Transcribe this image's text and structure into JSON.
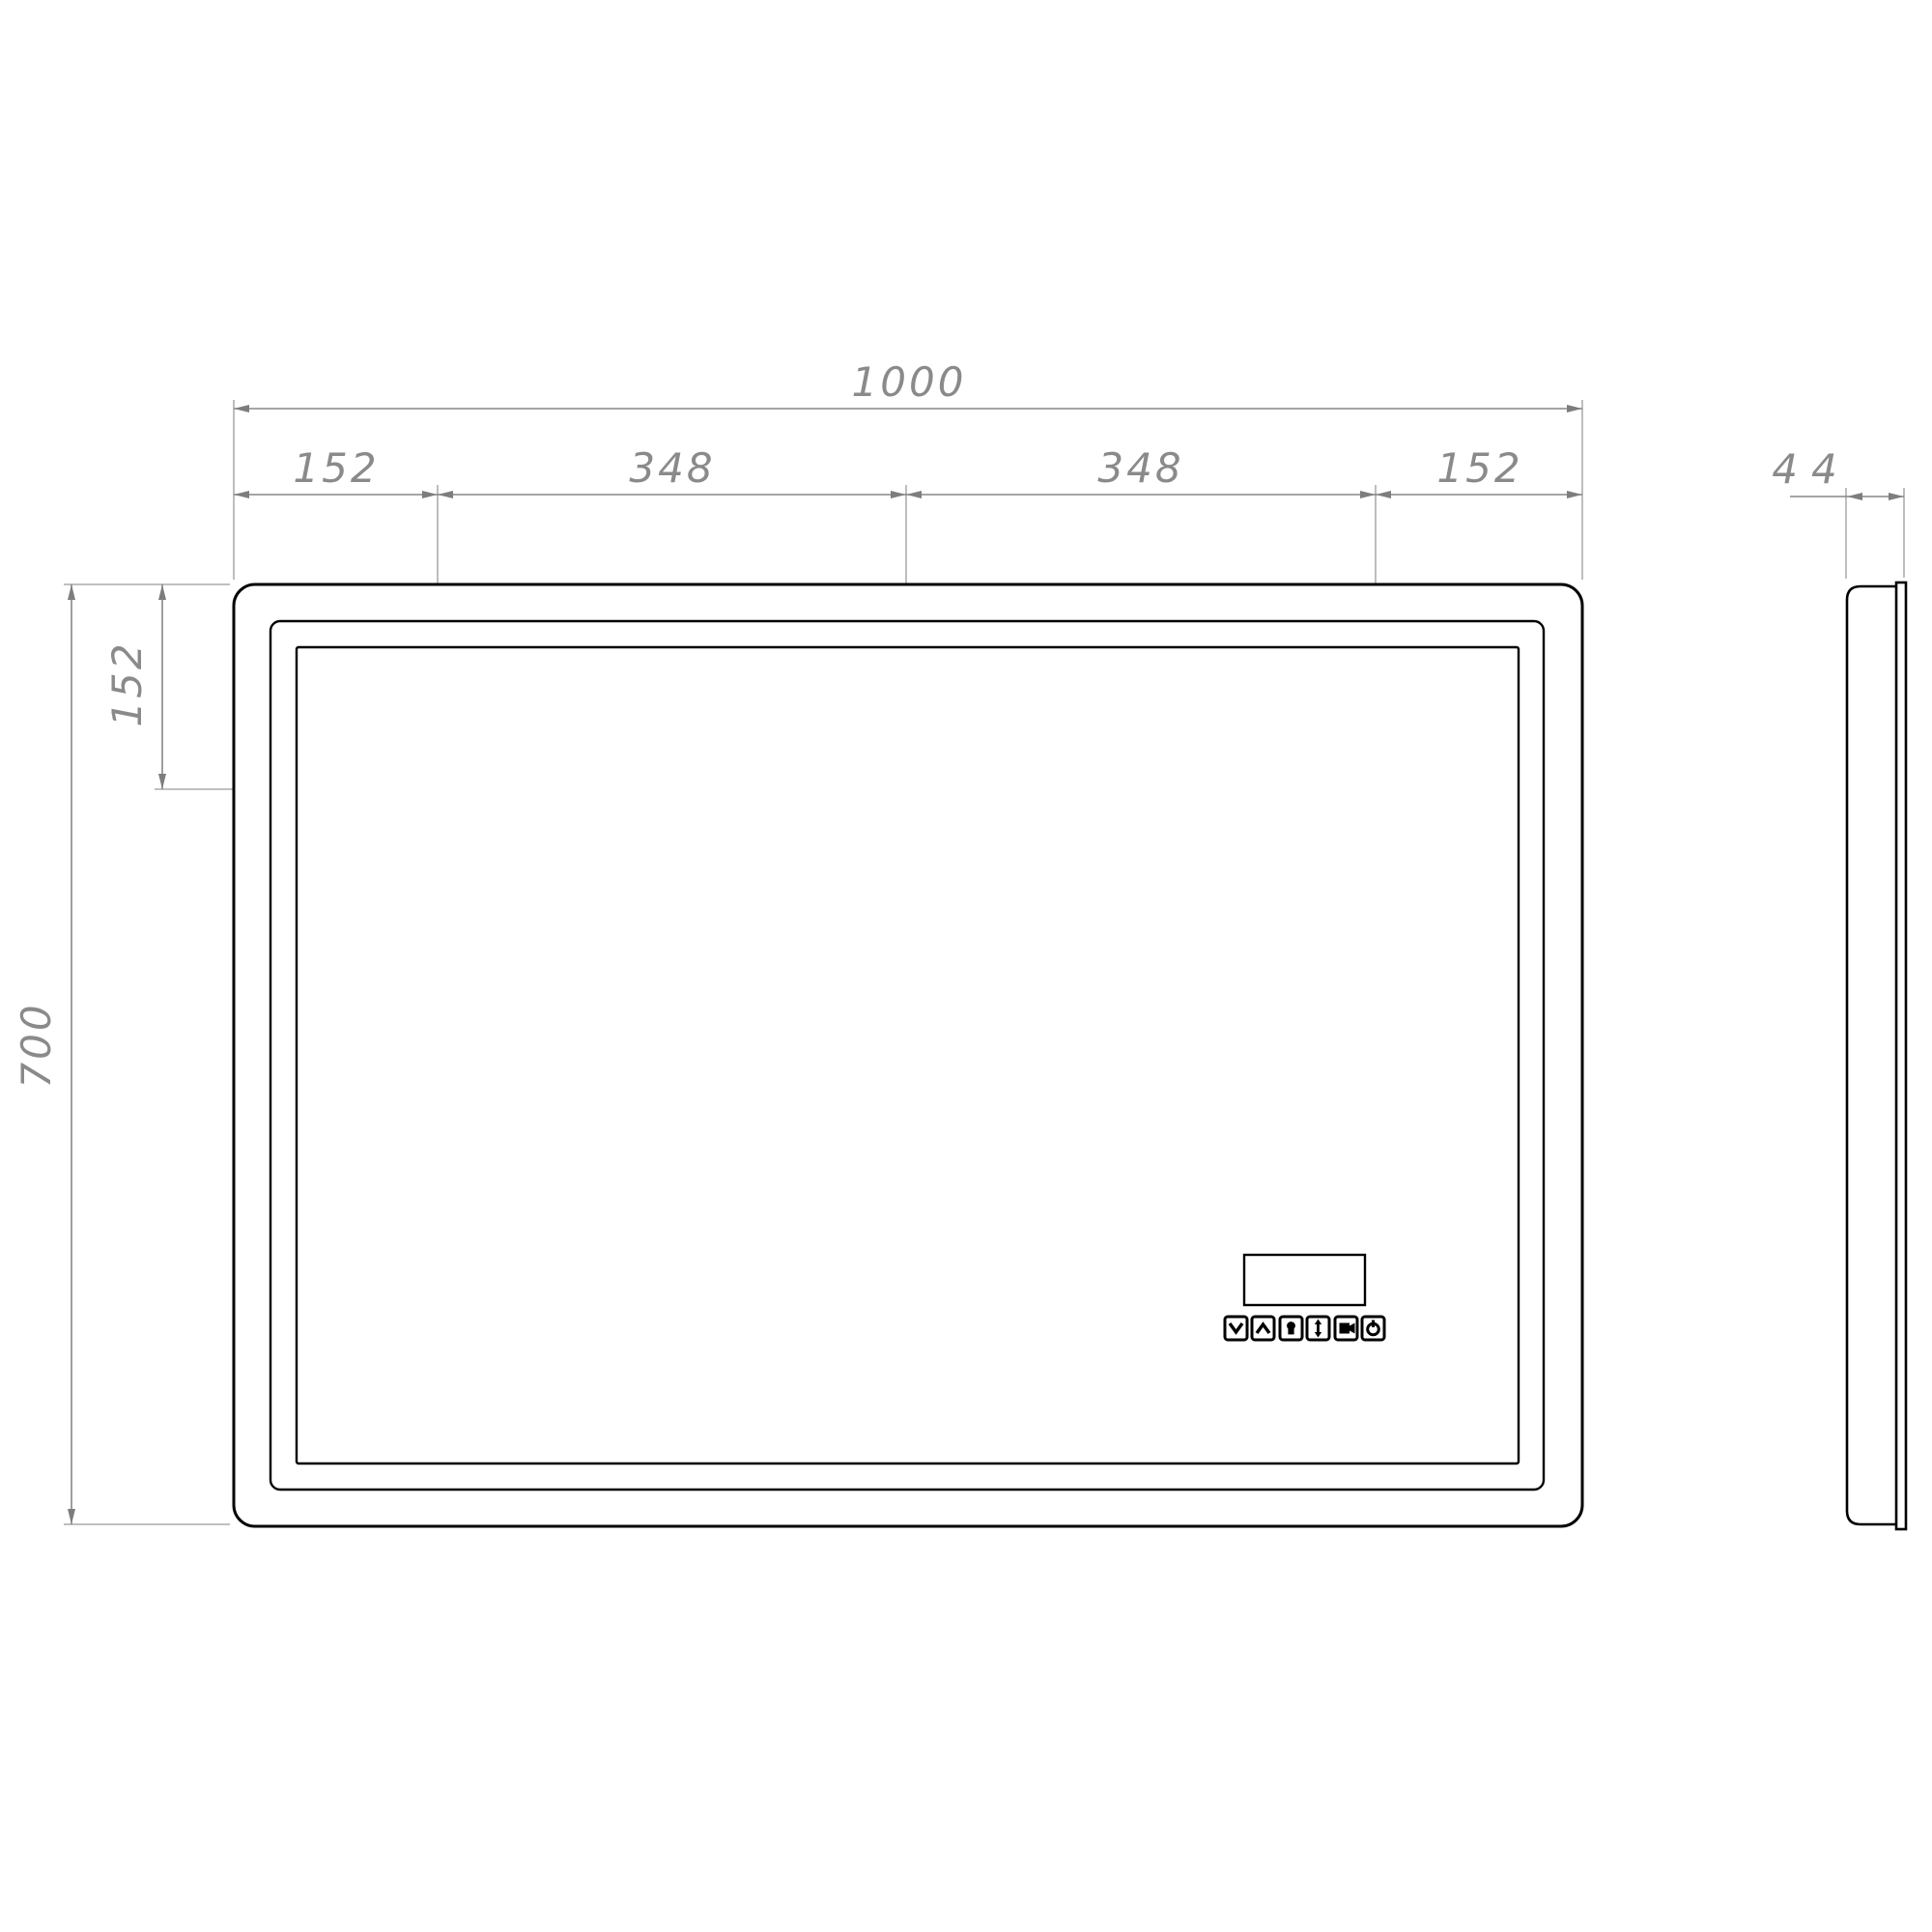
{
  "dimensions": {
    "total_width": "1000",
    "width_segments": [
      "152",
      "348",
      "348",
      "152"
    ],
    "height": "700",
    "mount_top_offset": "152",
    "depth": "44"
  },
  "mount_points": [
    {
      "label": "A"
    },
    {
      "label": "B"
    },
    {
      "label": "A"
    }
  ],
  "control_panel": {
    "icons": [
      {
        "name": "chevron-down"
      },
      {
        "name": "chevron-up"
      },
      {
        "name": "light"
      },
      {
        "name": "up-down-arrow"
      },
      {
        "name": "defogger"
      },
      {
        "name": "power"
      }
    ]
  },
  "colors": {
    "background": "#ffffff",
    "outline": "#000000",
    "dimension_lines": "#878787",
    "dimension_text": "#8a8a8a"
  }
}
